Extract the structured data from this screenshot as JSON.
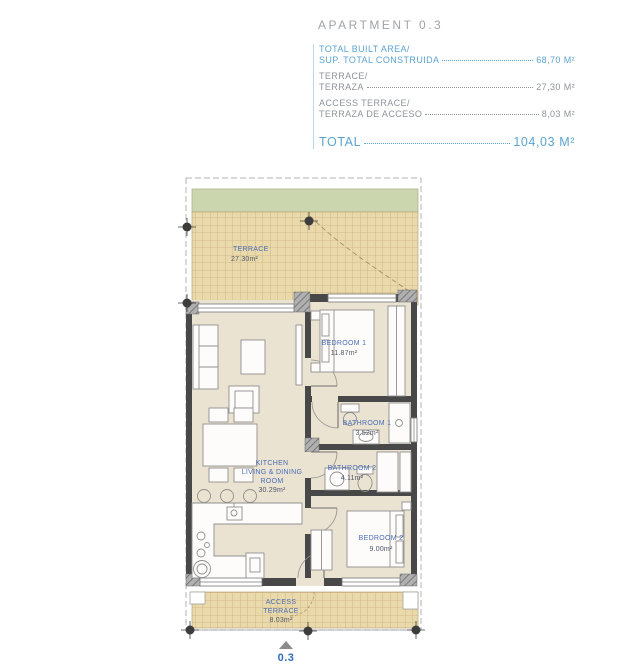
{
  "header": {
    "title": "APARTMENT 0.3",
    "specs": [
      {
        "line1": "TOTAL BUILT AREA/",
        "line2": "SUP. TOTAL CONSTRUIDA",
        "value": "68,70 M²"
      },
      {
        "line1": "TERRACE/",
        "line2": "TERRAZA",
        "value": "27,30 M²"
      },
      {
        "line1": "ACCESS TERRACE/",
        "line2": "TERRAZA DE ACCESO",
        "value": "8,03 M²"
      }
    ],
    "total_label": "TOTAL",
    "total_value": "104,03 M²"
  },
  "plan": {
    "terrace": {
      "name": "TERRACE",
      "area": "27.30m²"
    },
    "bedroom1": {
      "name": "BEDROOM 1",
      "area": "11.87m²"
    },
    "bathroom1": {
      "name": "BATHROOM 1",
      "area": "3.52m²"
    },
    "bathroom2": {
      "name": "BATHROOM 2",
      "area": "4.11m²"
    },
    "kitchen": {
      "line1": "KITCHEN",
      "line2": "LIVING & DINING",
      "line3": "ROOM",
      "area": "30.29m²"
    },
    "bedroom2": {
      "name": "BEDROOM 2",
      "area": "9.00m²"
    },
    "access_terrace": {
      "line1": "ACCESS",
      "line2": "TERRACE",
      "area": "8.03m²"
    },
    "unit_marker": "0.3"
  },
  "colors": {
    "header_accent": "#5ba3d0",
    "header_text": "#8f9499",
    "room_label_blue": "#4a6db6",
    "room_label_dark": "#4f5867",
    "terrace_tile": "#ead9ab",
    "planter_green": "#cbd6ae",
    "wall": "#484848",
    "floor": "#ebe3d2"
  }
}
